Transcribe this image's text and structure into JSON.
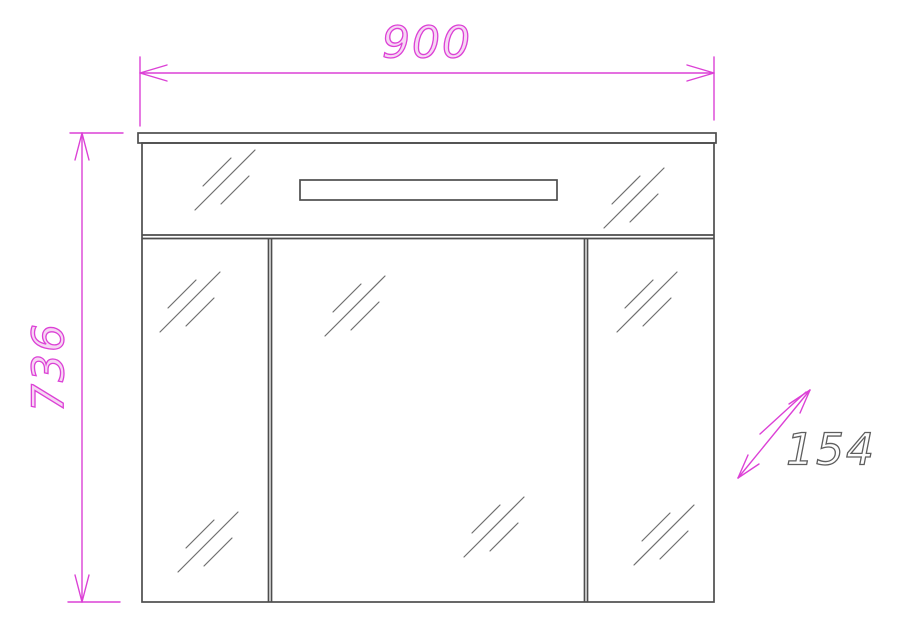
{
  "drawing": {
    "type": "technical-dimension-drawing",
    "subject": "mirror-cabinet-front-elevation",
    "dimensions": {
      "width_label": "900",
      "height_label": "736",
      "depth_label": "154"
    },
    "colors": {
      "dimension_line": "#dc41d6",
      "outline": "#4d4d4d",
      "hatch": "#6f6f6f",
      "depth_text": "#5e5e5e",
      "background": "#ffffff"
    }
  }
}
